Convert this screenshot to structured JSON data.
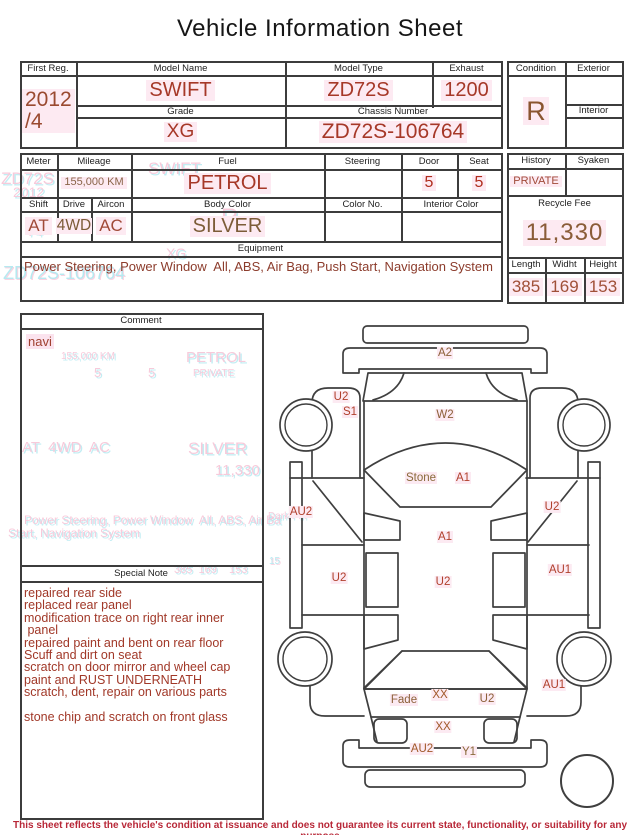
{
  "title": "Vehicle Information Sheet",
  "vehicle": {
    "first_reg": {
      "label": "First Reg.",
      "value": "2012\n/4"
    },
    "model_name": {
      "label": "Model Name",
      "value": "SWIFT"
    },
    "model_type": {
      "label": "Model Type",
      "value": "ZD72S"
    },
    "exhaust": {
      "label": "Exhaust",
      "value": "1200"
    },
    "grade": {
      "label": "Grade",
      "value": "XG"
    },
    "chassis_number": {
      "label": "Chassis Number",
      "value": "ZD72S-106764"
    },
    "condition": {
      "label": "Condition",
      "value": "R"
    },
    "exterior": {
      "label": "Exterior",
      "value": ""
    },
    "interior": {
      "label": "Interior",
      "value": ""
    }
  },
  "details": {
    "meter": {
      "label": "Meter",
      "value": ""
    },
    "mileage": {
      "label": "Mileage",
      "value": "155,000 KM"
    },
    "fuel": {
      "label": "Fuel",
      "value": "PETROL"
    },
    "steering": {
      "label": "Steering",
      "value": ""
    },
    "door": {
      "label": "Door",
      "value": "5"
    },
    "seat": {
      "label": "Seat",
      "value": "5"
    },
    "shift": {
      "label": "Shift",
      "value": "AT"
    },
    "drive": {
      "label": "Drive",
      "value": "4WD"
    },
    "aircon": {
      "label": "Aircon",
      "value": "AC"
    },
    "body_color": {
      "label": "Body Color",
      "value": "SILVER"
    },
    "color_no": {
      "label": "Color No.",
      "value": ""
    },
    "interior_color": {
      "label": "Interior Color",
      "value": ""
    },
    "equipment": {
      "label": "Equipment",
      "value": "Power Steering, Power Window  All, ABS, Air Bag, Push Start, Navigation System"
    },
    "history": {
      "label": "History",
      "value": "PRIVATE"
    },
    "syaken": {
      "label": "Syaken",
      "value": ""
    },
    "recycle_fee": {
      "label": "Recycle Fee",
      "value": "11,330"
    },
    "length": {
      "label": "Length",
      "value": "385"
    },
    "widht": {
      "label": "Widht",
      "value": "169"
    },
    "height": {
      "label": "Height",
      "value": "153"
    }
  },
  "comment": {
    "label": "Comment",
    "text": "navi"
  },
  "special_note": {
    "label": "Special Note",
    "lines": [
      "repaired rear side",
      "replaced rear panel",
      "modification trace on right rear inner",
      " panel",
      "repaired paint and bent on rear floor",
      "Scuff and dirt on seat",
      "scratch on door mirror and wheel cap",
      "paint and RUST UNDERNEATH",
      "scratch, dent, repair on various parts",
      "",
      "stone chip and scratch on front glass"
    ]
  },
  "diagram": {
    "labels": [
      {
        "text": "A2",
        "x": 445,
        "y": 353,
        "tone": "t-brown"
      },
      {
        "text": "U2",
        "x": 341,
        "y": 397,
        "tone": "t-red"
      },
      {
        "text": "S1",
        "x": 350,
        "y": 412,
        "tone": "t-red"
      },
      {
        "text": "W2",
        "x": 445,
        "y": 415,
        "tone": "t-brown"
      },
      {
        "text": "Stone",
        "x": 421,
        "y": 478,
        "tone": "t-olive"
      },
      {
        "text": "A1",
        "x": 463,
        "y": 478,
        "tone": "t-red"
      },
      {
        "text": "AU2",
        "x": 301,
        "y": 512,
        "tone": "t-red"
      },
      {
        "text": "U2",
        "x": 552,
        "y": 507,
        "tone": "t-red"
      },
      {
        "text": "A1",
        "x": 445,
        "y": 537,
        "tone": "t-red"
      },
      {
        "text": "AU1",
        "x": 560,
        "y": 570,
        "tone": "t-red"
      },
      {
        "text": "U2",
        "x": 339,
        "y": 578,
        "tone": "t-red"
      },
      {
        "text": "U2",
        "x": 443,
        "y": 582,
        "tone": "t-red"
      },
      {
        "text": "AU1",
        "x": 554,
        "y": 685,
        "tone": "t-red"
      },
      {
        "text": "Fade",
        "x": 404,
        "y": 700,
        "tone": "t-brown"
      },
      {
        "text": "XX",
        "x": 440,
        "y": 695,
        "tone": "t-rust"
      },
      {
        "text": "U2",
        "x": 487,
        "y": 699,
        "tone": "t-brown"
      },
      {
        "text": "XX",
        "x": 443,
        "y": 727,
        "tone": "t-rust"
      },
      {
        "text": "AU2",
        "x": 422,
        "y": 749,
        "tone": "t-rust"
      },
      {
        "text": "Y1",
        "x": 469,
        "y": 752,
        "tone": "t-olive"
      }
    ]
  },
  "ghosts": [
    {
      "text": "ZD72S",
      "x": 1,
      "y": 170,
      "size": 17,
      "c": "gpink"
    },
    {
      "text": "2012",
      "x": 13,
      "y": 185,
      "size": 14,
      "c": "gpink"
    },
    {
      "text": "SWIFT",
      "x": 148,
      "y": 160,
      "size": 17,
      "c": "gpink"
    },
    {
      "text": "1200",
      "x": 190,
      "y": 171,
      "size": 17,
      "c": "gpink"
    },
    {
      "text": "74",
      "x": 27,
      "y": 224,
      "size": 14,
      "c": "gpink"
    },
    {
      "text": "R",
      "x": 221,
      "y": 206,
      "size": 24,
      "c": "gpink"
    },
    {
      "text": "XG",
      "x": 166,
      "y": 246,
      "size": 14,
      "c": "gpink"
    },
    {
      "text": "ZD72S-106764",
      "x": 3,
      "y": 264,
      "size": 18,
      "c": "gcyan"
    },
    {
      "text": "155,000 KM",
      "x": 61,
      "y": 352,
      "size": 10,
      "c": "gpink"
    },
    {
      "text": "PETROL",
      "x": 186,
      "y": 350,
      "size": 15,
      "c": "gpink"
    },
    {
      "text": "5",
      "x": 94,
      "y": 366,
      "size": 13,
      "c": "gpink"
    },
    {
      "text": "5",
      "x": 148,
      "y": 366,
      "size": 13,
      "c": "gpink"
    },
    {
      "text": "PRIVATE",
      "x": 193,
      "y": 369,
      "size": 10,
      "c": "gpink"
    },
    {
      "text": "AT  4WD  AC",
      "x": 22,
      "y": 440,
      "size": 15,
      "c": "gpink"
    },
    {
      "text": "SILVER",
      "x": 188,
      "y": 440,
      "size": 17,
      "c": "gpink"
    },
    {
      "text": "11,330",
      "x": 215,
      "y": 463,
      "size": 15,
      "c": "gpink"
    },
    {
      "text": "Power Steering, Power Window  All, ABS, Air Ba",
      "x": 24,
      "y": 514,
      "size": 12,
      "c": "gpink"
    },
    {
      "text": "Start, Navigation System",
      "x": 8,
      "y": 527,
      "size": 12,
      "c": "gpink"
    },
    {
      "text": "385  169    153",
      "x": 174,
      "y": 565,
      "size": 11,
      "c": "gpink"
    },
    {
      "text": "Dark Pin",
      "x": 268,
      "y": 512,
      "size": 10,
      "c": "gpink"
    },
    {
      "text": "15",
      "x": 269,
      "y": 557,
      "size": 10,
      "c": "gcyan"
    }
  ],
  "footer": {
    "disclaimer": "This sheet reflects the vehicle's condition at issuance and does not guarantee its current state, functionality, or suitability for any purpose"
  }
}
